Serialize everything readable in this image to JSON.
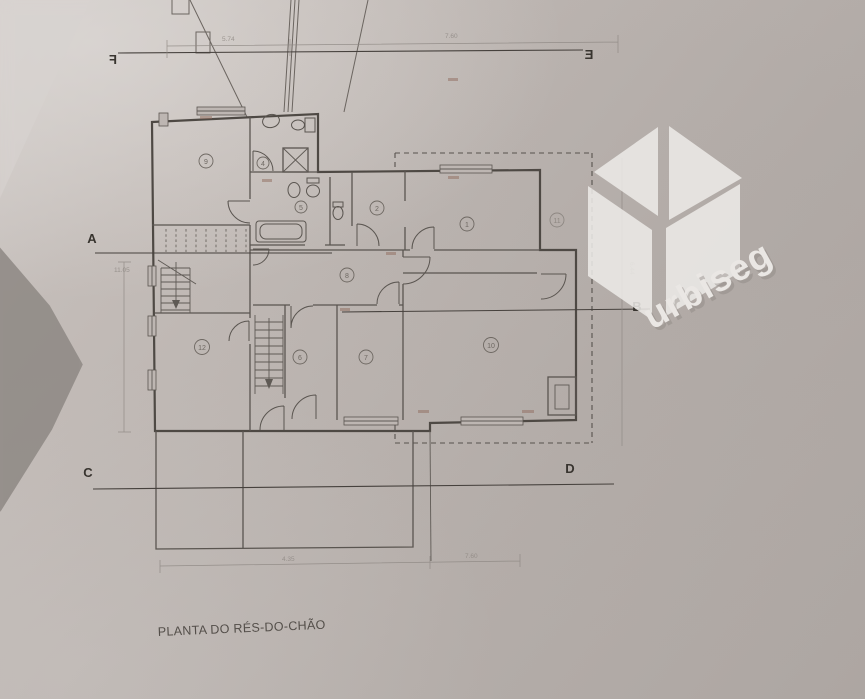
{
  "photo": {
    "paper_color": "#bab3af",
    "line_color": "#55504c",
    "watermark_color": "#eeece9"
  },
  "title": {
    "label": "PLANTA DO RÉS-DO-CHÃO"
  },
  "watermark": {
    "brand": "urbiseg"
  },
  "section_markers": {
    "a": "A",
    "b": "B",
    "c": "C",
    "d": "D",
    "e": "E",
    "f": "F"
  },
  "dimensions": {
    "top_left": "5.74",
    "top_right": "7.60",
    "bottom_left": "4.35",
    "bottom_right": "7.60",
    "left_height": "11.05",
    "right_height": "6.44"
  },
  "rooms": {
    "r1": "1",
    "r2": "2",
    "r4": "4",
    "r5": "5",
    "r6": "6",
    "r7": "7",
    "r8": "8",
    "r9": "9",
    "r10": "10",
    "r11": "11",
    "r12": "12"
  }
}
